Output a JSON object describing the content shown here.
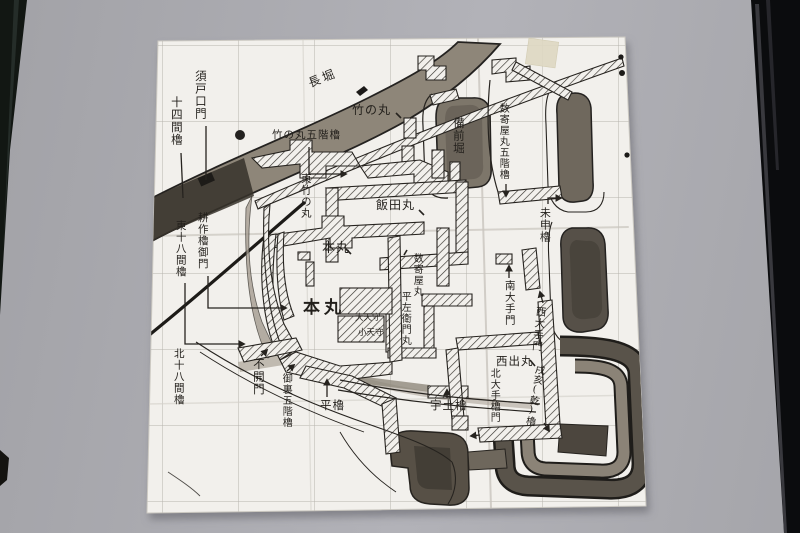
{
  "photo": {
    "colors": {
      "wall_background": "#aaaaaf",
      "paper": "#f2f0ec",
      "ink": "#26231f",
      "moat_wash": "#8e8679",
      "dark_moat": "#575147",
      "pencil_grid": "#b8b5af",
      "frame_dark": "#0e1011",
      "tape": "#ded8c2"
    }
  },
  "map": {
    "labels": [
      {
        "id": "nagahori",
        "text": "長堀"
      },
      {
        "id": "sudoguchi-mon",
        "text": "須戸口門"
      },
      {
        "id": "juyonken-yagura",
        "text": "十四間櫓"
      },
      {
        "id": "takenomaru",
        "text": "竹の丸"
      },
      {
        "id": "takenomaru-gokai-yagura",
        "text": "竹の丸五階櫓"
      },
      {
        "id": "higashi-takenomaru",
        "text": "東竹の丸"
      },
      {
        "id": "bizenbori",
        "text": "備前堀"
      },
      {
        "id": "sukiyamaru-gokai-yagura",
        "text": "数寄屋丸五階櫓"
      },
      {
        "id": "iidamaru",
        "text": "飯田丸"
      },
      {
        "id": "hitsujisaru-yagura",
        "text": "未申櫓"
      },
      {
        "id": "kosaku-yagura-gomon",
        "text": "耕作櫓御門"
      },
      {
        "id": "higashi-juhachiken-yagura",
        "text": "東十八間櫓"
      },
      {
        "id": "honmaru-north",
        "text": "本丸"
      },
      {
        "id": "sukiyamaru",
        "text": "数寄屋丸"
      },
      {
        "id": "minami-otemon",
        "text": "南大手門"
      },
      {
        "id": "nishi-otemon",
        "text": "西大手門"
      },
      {
        "id": "honmaru",
        "text": "本丸"
      },
      {
        "id": "dai-tenshu",
        "text": "大天守"
      },
      {
        "id": "ko-tenshu",
        "text": "小天守"
      },
      {
        "id": "hirazaemon-maru",
        "text": "平左衛門丸"
      },
      {
        "id": "nishidemaru",
        "text": "西出丸"
      },
      {
        "id": "kita-juhachiken-yagura",
        "text": "北十八間櫓"
      },
      {
        "id": "akazu-mon",
        "text": "不開門"
      },
      {
        "id": "onura-gokai-yagura",
        "text": "御裏五階櫓"
      },
      {
        "id": "hira-yagura",
        "text": "平櫓"
      },
      {
        "id": "uto-yagura",
        "text": "宇土櫓"
      },
      {
        "id": "kita-ote-yagura-mon",
        "text": "北大手櫓門"
      },
      {
        "id": "inui-yagura",
        "text": "戌亥(乾)櫓"
      }
    ]
  }
}
